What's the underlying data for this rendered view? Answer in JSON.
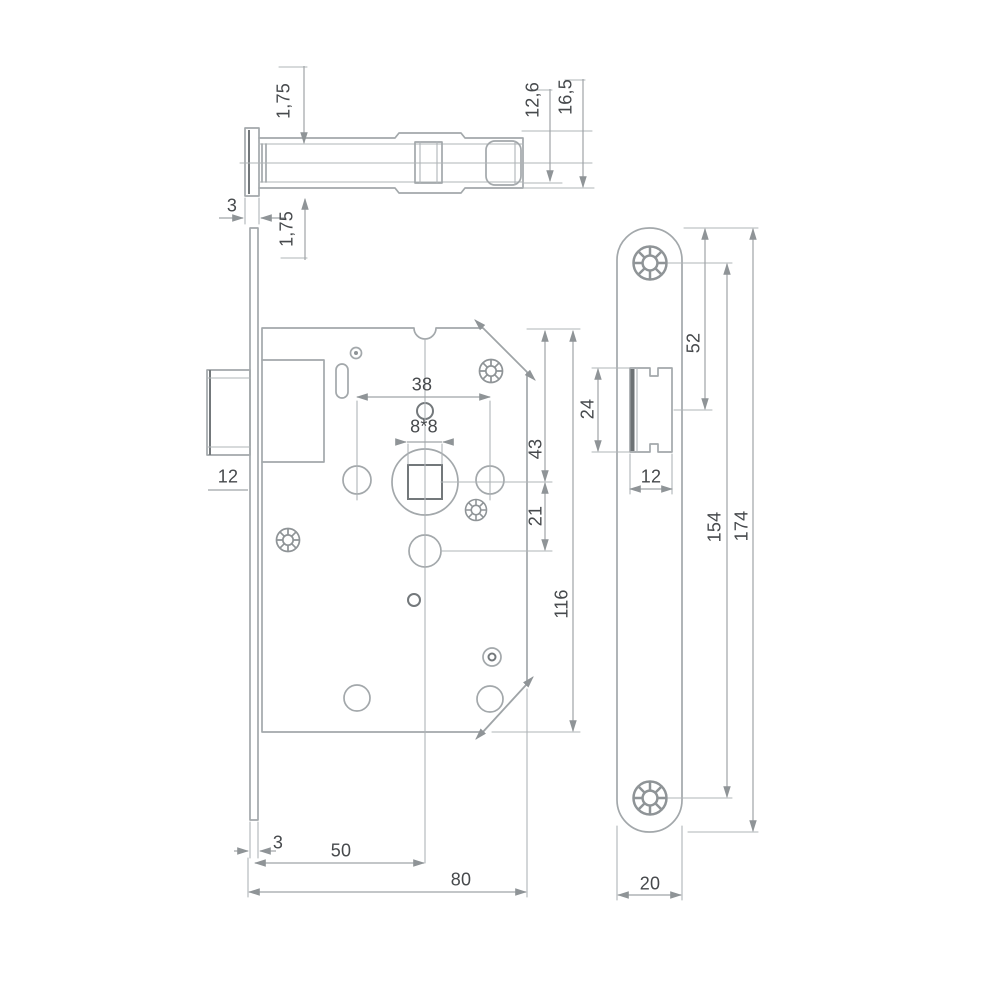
{
  "meta": {
    "type": "technical-drawing",
    "subject": "Mortise door lock with rounded faceplate, three orthographic views with dimensions (mm)"
  },
  "colors": {
    "background": "#ffffff",
    "line": "#a3a8ab",
    "dark_line": "#73787b",
    "dimension_line": "#9fa4a7",
    "text": "#46494c"
  },
  "dims": {
    "top_offset_upper": "1,75",
    "top_plate_thickness": "3",
    "top_offset_lower": "1,75",
    "top_inner_height": "12,6",
    "top_total_height": "16,5",
    "front_latch_width": "12",
    "front_hole_spacing": "38",
    "front_spindle_square": "8*8",
    "front_top_to_spindle": "43",
    "front_spindle_to_lower": "21",
    "front_case_height": "116",
    "front_plate_thickness": "3",
    "front_backset": "50",
    "front_case_depth": "80",
    "side_latch_height": "24",
    "side_latch_width": "12",
    "side_top_to_latch": "52",
    "side_screw_spacing": "154",
    "side_plate_length": "174",
    "side_plate_width": "20"
  }
}
